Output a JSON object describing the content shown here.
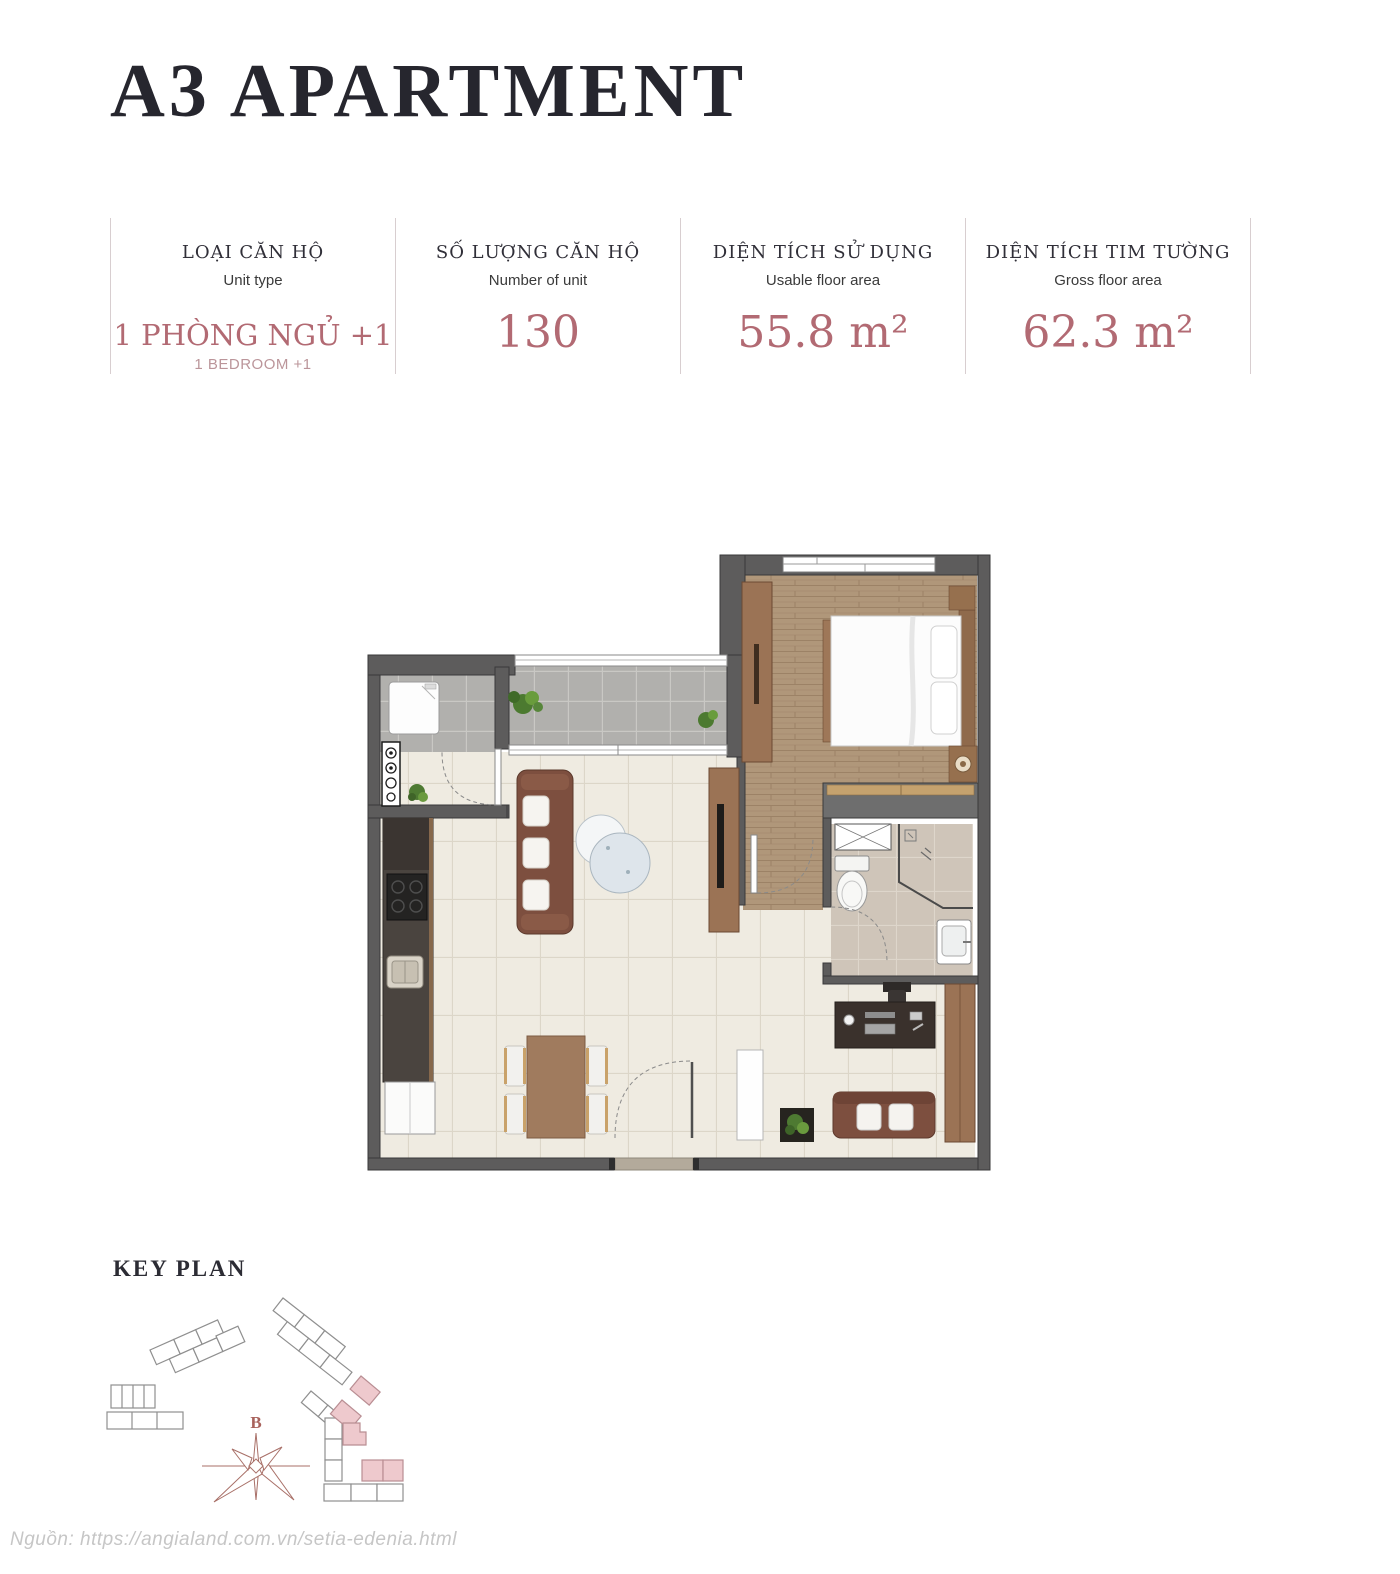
{
  "page": {
    "title": "A3 APARTMENT",
    "source_note": "Nguồn: https://angialand.com.vn/setia-edenia.html"
  },
  "stats": {
    "columns": [
      {
        "label_vi": "LOẠI CĂN HỘ",
        "label_en": "Unit type",
        "value": "1 PHÒNG NGỦ +1",
        "value_sub": "1 BEDROOM +1"
      },
      {
        "label_vi": "SỐ LƯỢNG CĂN HỘ",
        "label_en": "Number of unit",
        "value": "130"
      },
      {
        "label_vi": "DIỆN TÍCH SỬ DỤNG",
        "label_en": "Usable floor area",
        "value": "55.8 m²"
      },
      {
        "label_vi": "DIỆN TÍCH TIM TƯỜNG",
        "label_en": "Gross floor area",
        "value": "62.3 m²"
      }
    ]
  },
  "key_plan": {
    "title": "KEY PLAN",
    "compass_label": "B"
  },
  "colors": {
    "accent_rose": "#b26a73",
    "title_dark": "#26262e",
    "divider": "#d8ced0",
    "wall_gray": "#5d5c5c",
    "floor_wood": "#b0977a",
    "floor_beige": "#efebe1",
    "floor_gray_tile": "#b1b0ad",
    "bath_tile": "#cfc5b9",
    "furniture_brown": "#9b7355",
    "sofa_brown": "#7d4f3f",
    "keyplan_pink": "#eec9cd"
  }
}
